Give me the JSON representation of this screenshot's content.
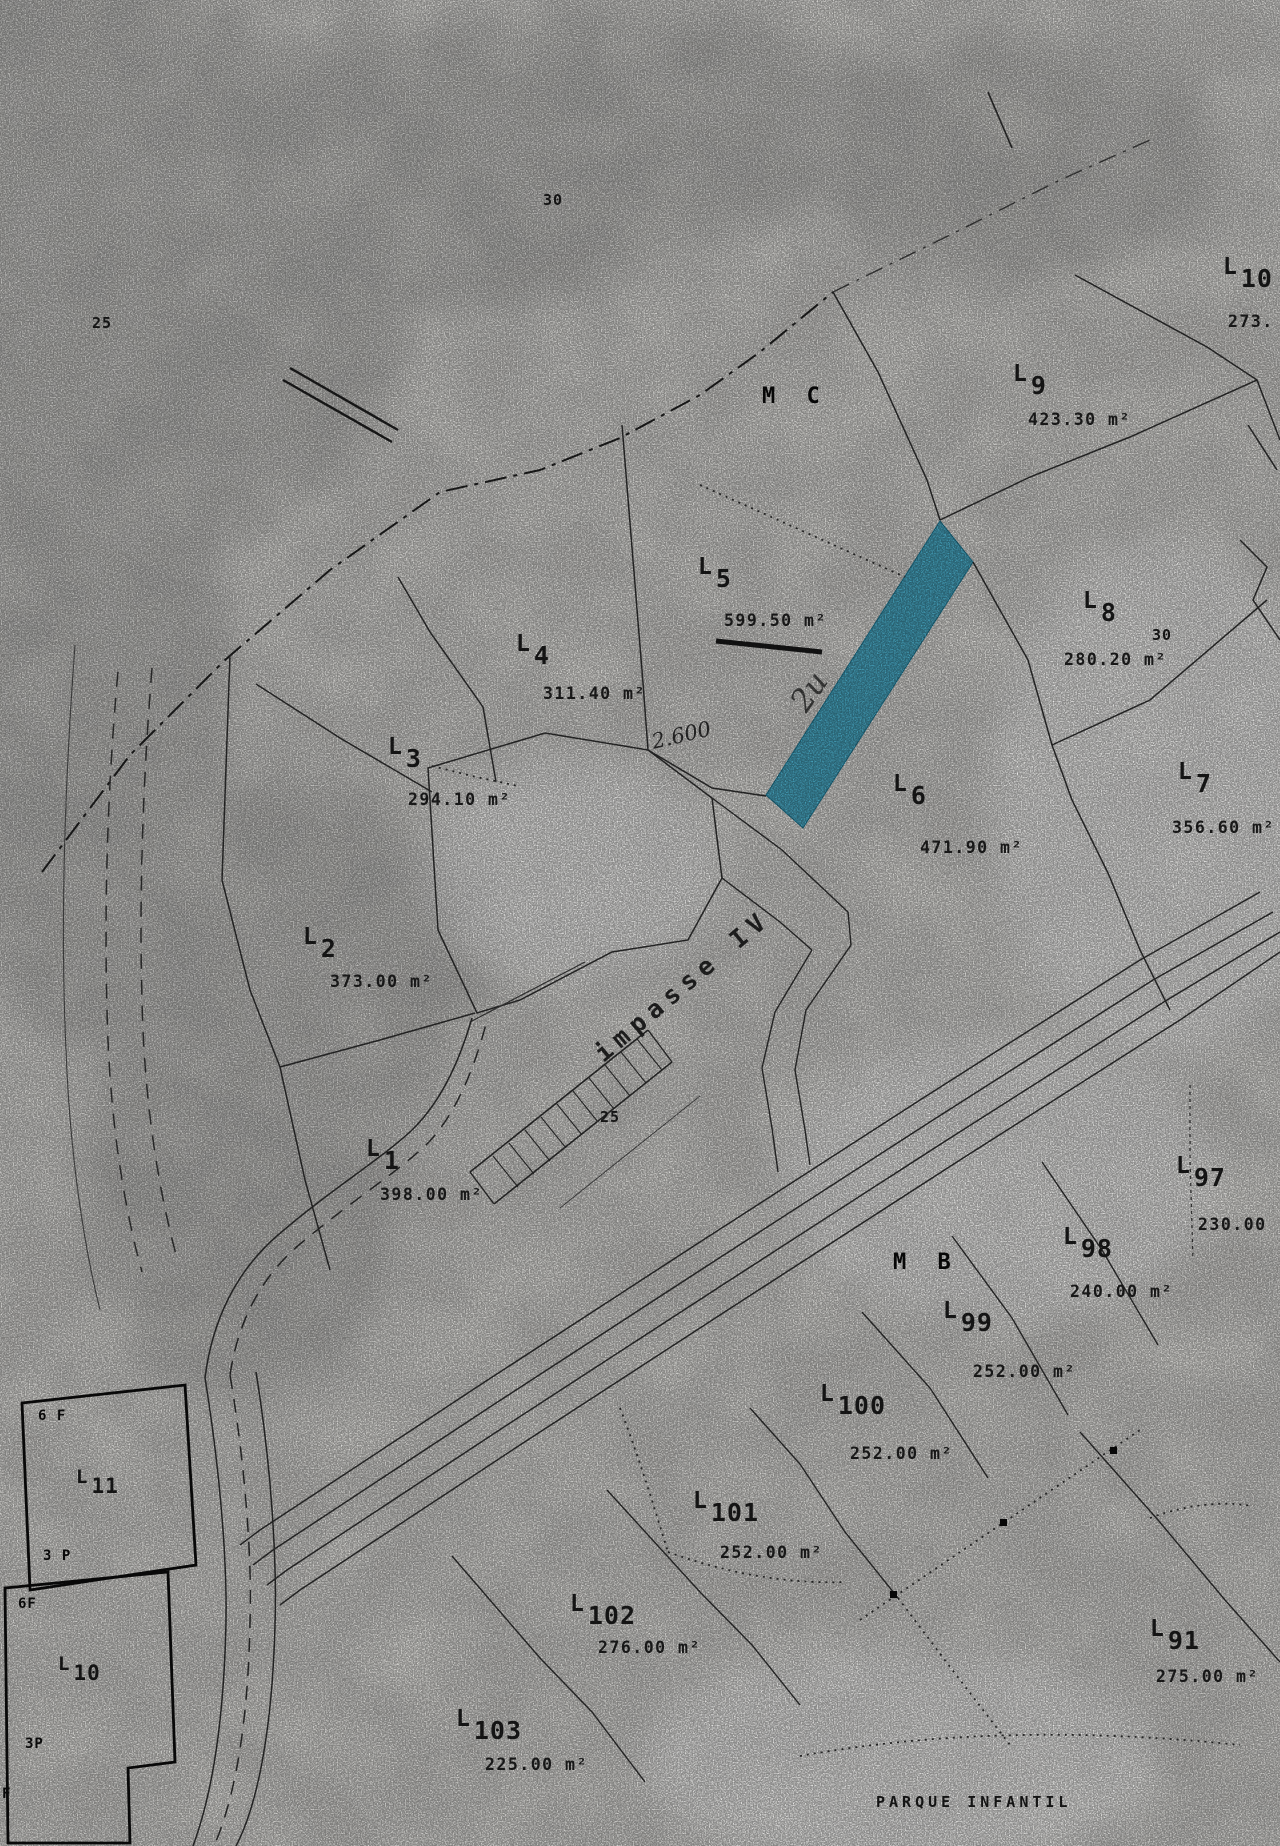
{
  "map": {
    "regions": {
      "mc": "M C",
      "mb": "M B"
    },
    "street_label": "impasse IV",
    "park_label": "PARQUE INFANTIL",
    "marks": {
      "top": "30",
      "left": "25",
      "street": "25",
      "l8": "30"
    },
    "handwriting": {
      "measure": "2.600",
      "scribble": "2u"
    },
    "highlight_color": "#2E9FC0",
    "parcels": [
      {
        "l": "L",
        "n": "1",
        "area": "398.00 m²"
      },
      {
        "l": "L",
        "n": "2",
        "area": "373.00 m²"
      },
      {
        "l": "L",
        "n": "3",
        "area": "294.10 m²"
      },
      {
        "l": "L",
        "n": "4",
        "area": "311.40 m²"
      },
      {
        "l": "L",
        "n": "5",
        "area": "599.50 m²"
      },
      {
        "l": "L",
        "n": "6",
        "area": "471.90 m²"
      },
      {
        "l": "L",
        "n": "7",
        "area": "356.60 m²"
      },
      {
        "l": "L",
        "n": "8",
        "area": "280.20 m²"
      },
      {
        "l": "L",
        "n": "9",
        "area": "423.30 m²"
      },
      {
        "l": "L",
        "n": "10",
        "area": "273."
      },
      {
        "l": "L",
        "n": "91",
        "area": "275.00 m²"
      },
      {
        "l": "L",
        "n": "97",
        "area": "230.00"
      },
      {
        "l": "L",
        "n": "98",
        "area": "240.00 m²"
      },
      {
        "l": "L",
        "n": "99",
        "area": "252.00 m²"
      },
      {
        "l": "L",
        "n": "100",
        "area": "252.00 m²"
      },
      {
        "l": "L",
        "n": "101",
        "area": "252.00 m²"
      },
      {
        "l": "L",
        "n": "102",
        "area": "276.00 m²"
      },
      {
        "l": "L",
        "n": "103",
        "area": "225.00 m²"
      }
    ],
    "houses": [
      {
        "l": "L",
        "n": "11",
        "floors": "6 F",
        "base": "3 P"
      },
      {
        "l": "L",
        "n": "10",
        "floors": "6F",
        "base": "3P"
      },
      {
        "partial": "F"
      }
    ]
  }
}
